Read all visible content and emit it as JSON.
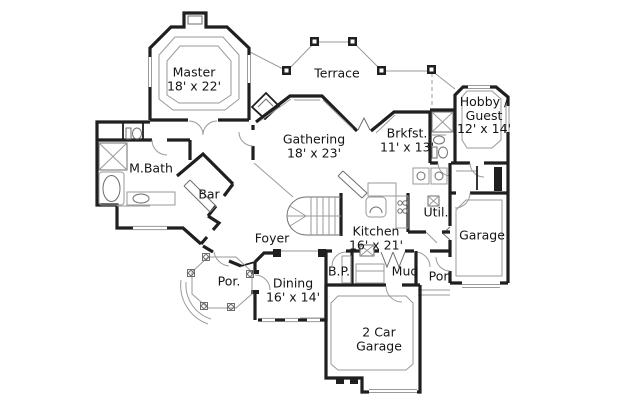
{
  "figure": "residential floor plan",
  "colors": {
    "background": "#ffffff",
    "walls": "#1f1f1f",
    "details": "#9a9a9a",
    "fixtures": "#6e6e6e",
    "text": "#141414"
  },
  "rooms": [
    {
      "name": "Master",
      "dims": "18' x 22'"
    },
    {
      "name": "Terrace",
      "dims": ""
    },
    {
      "name": "Hobby / Guest",
      "dims": "12' x 14'"
    },
    {
      "name": "M.Bath",
      "dims": ""
    },
    {
      "name": "Gathering",
      "dims": "18' x 23'"
    },
    {
      "name": "Brkfst.",
      "dims": "11' x 13'"
    },
    {
      "name": "Bar",
      "dims": ""
    },
    {
      "name": "Foyer",
      "dims": ""
    },
    {
      "name": "Kitchen",
      "dims": "16' x 21'"
    },
    {
      "name": "Util.",
      "dims": ""
    },
    {
      "name": "Garage",
      "dims": ""
    },
    {
      "name": "Por.",
      "dims": ""
    },
    {
      "name": "Dining",
      "dims": "16' x 14'"
    },
    {
      "name": "B.P.",
      "dims": ""
    },
    {
      "name": "Mud",
      "dims": ""
    },
    {
      "name": "Por.",
      "dims": ""
    },
    {
      "name": "2 Car Garage",
      "dims": ""
    }
  ]
}
